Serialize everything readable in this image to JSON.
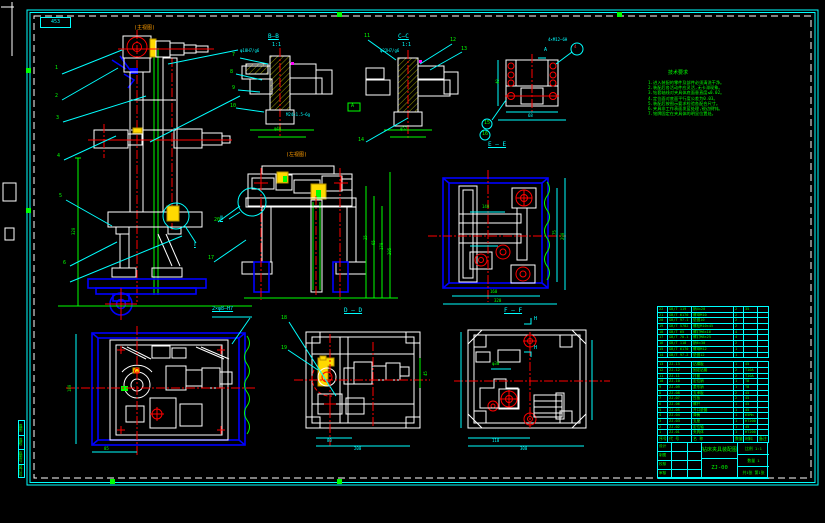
{
  "frame": {
    "corner_no": "453"
  },
  "view_labels": {
    "main_view": "(主视图)",
    "side_view": "(左视图)",
    "bb": "B—B",
    "bb_scale": "1:1",
    "cc": "C—C",
    "cc_scale": "1:1",
    "ee": "E — E",
    "dd": "D — D",
    "ff": "F — F",
    "detail1": "Ⅰ",
    "detail2": "Ⅱ",
    "flag_a": "A",
    "h_top": "H",
    "h_bot": "H",
    "datum": "A"
  },
  "callouts": {
    "holes": "2×φ8—H7"
  },
  "notes": {
    "title": "技术要求",
    "items": [
      "1.进入装配的零件及部件必须清洗干净。",
      "2.装配后各活动件应灵活,无卡滞现象。",
      "3.钻套轴线对夹具体底面垂直度≤0.02。",
      "4.定位面对底面平行度公差为0.03。",
      "5.装配后按图示要求检验各配合尺寸。",
      "6.夹具非工作表面发蓝处理,锐边倒钝。",
      "7.铭牌固定在夹具体的明显位置处。"
    ]
  },
  "dims": [
    {
      "t": "85",
      "x": 104,
      "y": 447,
      "c": "g"
    },
    {
      "t": "180",
      "x": 68,
      "y": 392,
      "c": "g",
      "r": 1
    },
    {
      "t": "320",
      "x": 72,
      "y": 235,
      "c": "g",
      "r": 1
    },
    {
      "t": "80",
      "x": 327,
      "y": 439,
      "c": "c"
    },
    {
      "t": "200",
      "x": 354,
      "y": 447,
      "c": "c"
    },
    {
      "t": "45",
      "x": 424,
      "y": 376,
      "c": "g",
      "r": 1
    },
    {
      "t": "110",
      "x": 492,
      "y": 439,
      "c": "c"
    },
    {
      "t": "300",
      "x": 520,
      "y": 447,
      "c": "c"
    },
    {
      "t": "φ30",
      "x": 492,
      "y": 362,
      "c": "g"
    },
    {
      "t": "160",
      "x": 490,
      "y": 290,
      "c": "g"
    },
    {
      "t": "320",
      "x": 494,
      "y": 299,
      "c": "g"
    },
    {
      "t": "140",
      "x": 482,
      "y": 205,
      "c": "g"
    },
    {
      "t": "75",
      "x": 553,
      "y": 235,
      "c": "g",
      "r": 1
    },
    {
      "t": "290",
      "x": 561,
      "y": 240,
      "c": "g",
      "r": 1
    },
    {
      "t": "40",
      "x": 496,
      "y": 84,
      "c": "g",
      "r": 1
    },
    {
      "t": "68",
      "x": 528,
      "y": 114,
      "c": "c"
    },
    {
      "t": "φ40",
      "x": 274,
      "y": 127,
      "c": "g"
    },
    {
      "t": "φ52",
      "x": 400,
      "y": 127,
      "c": "g"
    },
    {
      "t": "25",
      "x": 364,
      "y": 240,
      "c": "g",
      "r": 1
    },
    {
      "t": "65",
      "x": 372,
      "y": 245,
      "c": "g",
      "r": 1
    },
    {
      "t": "170",
      "x": 380,
      "y": 250,
      "c": "g",
      "r": 1
    },
    {
      "t": "205",
      "x": 388,
      "y": 255,
      "c": "g",
      "r": 1
    },
    {
      "t": "M24×1.5—6g",
      "x": 286,
      "y": 113,
      "c": "c"
    },
    {
      "t": "φ18H7/g6",
      "x": 240,
      "y": 49,
      "c": "c"
    },
    {
      "t": "φ22H7/g6",
      "x": 380,
      "y": 49,
      "c": "c"
    },
    {
      "t": "4×M12—6H",
      "x": 548,
      "y": 38,
      "c": "c"
    },
    {
      "t": "4",
      "x": 574,
      "y": 45,
      "c": "r"
    }
  ],
  "balloons": [
    {
      "n": "1",
      "x": 55,
      "y": 66
    },
    {
      "n": "2",
      "x": 55,
      "y": 94
    },
    {
      "n": "3",
      "x": 56,
      "y": 116
    },
    {
      "n": "4",
      "x": 57,
      "y": 154
    },
    {
      "n": "5",
      "x": 59,
      "y": 194
    },
    {
      "n": "6",
      "x": 63,
      "y": 261
    },
    {
      "n": "7",
      "x": 232,
      "y": 53
    },
    {
      "n": "8",
      "x": 230,
      "y": 70
    },
    {
      "n": "9",
      "x": 232,
      "y": 86
    },
    {
      "n": "10",
      "x": 230,
      "y": 104
    },
    {
      "n": "11",
      "x": 364,
      "y": 34
    },
    {
      "n": "12",
      "x": 450,
      "y": 38
    },
    {
      "n": "13",
      "x": 461,
      "y": 47
    },
    {
      "n": "14",
      "x": 358,
      "y": 138
    },
    {
      "n": "15",
      "x": 484,
      "y": 121
    },
    {
      "n": "16",
      "x": 482,
      "y": 132
    },
    {
      "n": "17",
      "x": 208,
      "y": 256
    },
    {
      "n": "18",
      "x": 281,
      "y": 316
    },
    {
      "n": "19",
      "x": 281,
      "y": 346
    },
    {
      "n": "20",
      "x": 214,
      "y": 218
    }
  ],
  "parts_list": {
    "headers": [
      "序号",
      "代  号",
      "名  称",
      "数量",
      "材料",
      "备注"
    ],
    "rows": [
      [
        "22",
        "GB/T 119",
        "销4×20",
        "2",
        "35",
        ""
      ],
      [
        "21",
        "GB/T 6170",
        "螺母M10",
        "2",
        "",
        ""
      ],
      [
        "20",
        "GB/T 97.1",
        "垫圈10",
        "2",
        "",
        ""
      ],
      [
        "19",
        "GB/T 5782",
        "螺栓M10×45",
        "2",
        "",
        ""
      ],
      [
        "18",
        "GB/T 65",
        "螺钉M6×16",
        "4",
        "",
        ""
      ],
      [
        "17",
        "GB/T 70.1",
        "螺钉M8×25",
        "4",
        "",
        ""
      ],
      [
        "16",
        "GB/T 118",
        "销6×30",
        "2",
        "",
        ""
      ],
      [
        "15",
        "GB/T 6170",
        "螺母M12",
        "1",
        "",
        ""
      ],
      [
        "14",
        "GB/T 97.2",
        "垫圈12",
        "1",
        "",
        ""
      ],
      [
        "13",
        "ZJ-13",
        "钻模板",
        "1",
        "45",
        ""
      ],
      [
        "12",
        "ZJ-12",
        "固定钻套",
        "2",
        "T10A",
        ""
      ],
      [
        "11",
        "ZJ-11",
        "衬套",
        "2",
        "T10A",
        ""
      ],
      [
        "10",
        "ZJ-10",
        "定位销",
        "1",
        "T8",
        ""
      ],
      [
        "9",
        "ZJ-09",
        "菱形销",
        "1",
        "T8",
        ""
      ],
      [
        "8",
        "ZJ-08",
        "支承板",
        "2",
        "45",
        ""
      ],
      [
        "7",
        "ZJ-07",
        "压板",
        "2",
        "45",
        ""
      ],
      [
        "6",
        "ZJ-06",
        "螺杆",
        "1",
        "45",
        ""
      ],
      [
        "5",
        "ZJ-05",
        "开口垫圈",
        "1",
        "45",
        ""
      ],
      [
        "4",
        "ZJ-04",
        "弹簧",
        "1",
        "65Mn",
        ""
      ],
      [
        "3",
        "ZJ-03",
        "支座",
        "1",
        "HT200",
        ""
      ],
      [
        "2",
        "ZJ-02",
        "定位轴",
        "1",
        "45",
        ""
      ],
      [
        "1",
        "ZJ-01",
        "夹具体",
        "1",
        "HT200",
        ""
      ]
    ]
  },
  "title_block": {
    "title": "钻床夹具装配图",
    "drawing_no": "ZJ-00",
    "sign_rows": [
      "设计",
      "制图",
      "校核",
      "审核"
    ],
    "right_cells": [
      "比例 1:1",
      "数量 1",
      "共1张 第1张"
    ]
  },
  "edge_strip": [
    "描图",
    "描校",
    "底图号",
    "装订号"
  ]
}
